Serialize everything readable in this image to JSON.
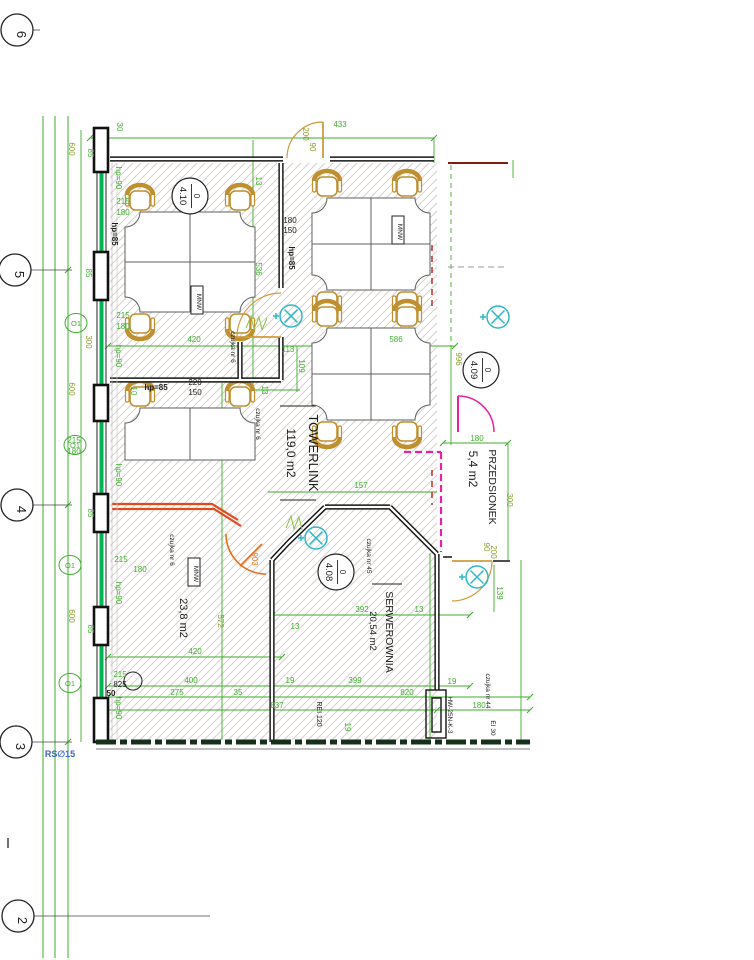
{
  "palette": {
    "dim": "#3fae2e",
    "olive": "#8a9b28",
    "black": "#1c1c1c",
    "tan": "#cf9b3d",
    "orange": "#e2711d",
    "magenta": "#e820a8",
    "teal": "#2fb6c9",
    "blue": "#3a66c4",
    "facade": "#00b551",
    "red": "#c23b22"
  },
  "drawing": {
    "grid_bubbles": [
      {
        "label": "6",
        "x": 17,
        "y": 30,
        "leader_to": 40
      },
      {
        "label": "5",
        "x": 15,
        "y": 270,
        "leader_to": 72
      },
      {
        "label": "4",
        "x": 17,
        "y": 505,
        "leader_to": 72
      },
      {
        "label": "3",
        "x": 16,
        "y": 742,
        "leader_to": 72
      },
      {
        "label": "2",
        "x": 18,
        "y": 916,
        "leader_to": 210
      }
    ],
    "room_bubbles": [
      {
        "prefix": "0",
        "number": "4.10",
        "x": 190,
        "y": 196
      },
      {
        "prefix": "0",
        "number": "4.09",
        "x": 481,
        "y": 370
      },
      {
        "prefix": "0",
        "number": "4.08",
        "x": 336,
        "y": 572
      }
    ],
    "room_labels": [
      {
        "t": "TOWERLINK",
        "x": 309,
        "y": 453,
        "r": 90,
        "c": "black",
        "s": 13
      },
      {
        "t": "119,0 m2",
        "x": 287,
        "y": 453,
        "r": 90,
        "c": "black",
        "s": 12
      },
      {
        "t": "PRZEDSIONEK",
        "x": 489,
        "y": 487,
        "r": 90,
        "c": "black",
        "s": 10.5
      },
      {
        "t": "5,4 m2",
        "x": 469,
        "y": 469,
        "r": 90,
        "c": "black",
        "s": 12
      },
      {
        "t": "SERWEROWNIA",
        "x": 386,
        "y": 632,
        "r": 90,
        "c": "black",
        "s": 10.5
      },
      {
        "t": "20,54 m2",
        "x": 370,
        "y": 631,
        "r": 90,
        "c": "black",
        "s": 9.5
      },
      {
        "t": "23,8 m2",
        "x": 180,
        "y": 618,
        "r": 90,
        "c": "black",
        "s": 11
      }
    ],
    "annotations": [
      {
        "t": "433",
        "x": 340,
        "y": 127
      },
      {
        "t": "30",
        "x": 117,
        "y": 127,
        "r": 90
      },
      {
        "t": "200",
        "x": 303,
        "y": 134,
        "r": 90,
        "c": "olive"
      },
      {
        "t": "90",
        "x": 310,
        "y": 147,
        "r": 90,
        "c": "olive"
      },
      {
        "t": "13",
        "x": 256,
        "y": 181,
        "r": 90
      },
      {
        "t": "600",
        "x": 69,
        "y": 149,
        "r": 90,
        "c": "olive"
      },
      {
        "t": "85",
        "x": 88,
        "y": 153,
        "r": 90
      },
      {
        "t": "hp=90",
        "x": 116,
        "y": 178,
        "r": 90
      },
      {
        "t": "215",
        "x": 123,
        "y": 204
      },
      {
        "t": "180",
        "x": 123,
        "y": 215
      },
      {
        "t": "hp=85",
        "x": 112,
        "y": 234,
        "r": 90,
        "c": "black",
        "w": "bold"
      },
      {
        "t": "85",
        "x": 86,
        "y": 273,
        "r": 90
      },
      {
        "t": "215",
        "x": 123,
        "y": 318
      },
      {
        "t": "180",
        "x": 123,
        "y": 329
      },
      {
        "t": "300",
        "x": 86,
        "y": 342,
        "r": 90,
        "c": "olive"
      },
      {
        "t": "hp=90",
        "x": 116,
        "y": 356,
        "r": 90
      },
      {
        "t": "600",
        "x": 69,
        "y": 389,
        "r": 90,
        "c": "olive"
      },
      {
        "t": "hp=85",
        "x": 156,
        "y": 390,
        "c": "black",
        "w": "bold"
      },
      {
        "t": "220",
        "x": 195,
        "y": 385,
        "c": "black"
      },
      {
        "t": "150",
        "x": 195,
        "y": 395,
        "c": "black"
      },
      {
        "t": "10",
        "x": 131,
        "y": 391,
        "r": 90
      },
      {
        "t": "215",
        "x": 74,
        "y": 443
      },
      {
        "t": "180",
        "x": 74,
        "y": 454
      },
      {
        "t": "hp=90",
        "x": 116,
        "y": 475,
        "r": 90
      },
      {
        "t": "85",
        "x": 88,
        "y": 513,
        "r": 90
      },
      {
        "t": "215",
        "x": 121,
        "y": 562
      },
      {
        "t": "180",
        "x": 140,
        "y": 572
      },
      {
        "t": "hp=90",
        "x": 116,
        "y": 593,
        "r": 90
      },
      {
        "t": "600",
        "x": 69,
        "y": 616,
        "r": 90,
        "c": "olive"
      },
      {
        "t": "85",
        "x": 88,
        "y": 629,
        "r": 90
      },
      {
        "t": "215",
        "x": 120,
        "y": 677
      },
      {
        "t": "825",
        "x": 120,
        "y": 687,
        "c": "black"
      },
      {
        "t": "50",
        "x": 111,
        "y": 696,
        "c": "black",
        "w": "bold"
      },
      {
        "t": "hp=90",
        "x": 116,
        "y": 708,
        "r": 90
      },
      {
        "t": "RS∅15",
        "x": 60,
        "y": 757,
        "c": "blue",
        "s": 9,
        "w": "bold"
      },
      {
        "t": "180",
        "x": 290,
        "y": 223,
        "c": "black"
      },
      {
        "t": "150",
        "x": 290,
        "y": 233,
        "c": "black"
      },
      {
        "t": "hp=85",
        "x": 289,
        "y": 258,
        "r": 90,
        "c": "black",
        "w": "bold"
      },
      {
        "t": "536",
        "x": 256,
        "y": 269,
        "r": 90
      },
      {
        "t": "420",
        "x": 194,
        "y": 342
      },
      {
        "t": "113",
        "x": 288,
        "y": 352
      },
      {
        "t": "109",
        "x": 299,
        "y": 366,
        "r": 90
      },
      {
        "t": "586",
        "x": 396,
        "y": 342
      },
      {
        "t": "13",
        "x": 262,
        "y": 390,
        "r": 90
      },
      {
        "t": "czujka nr 6",
        "x": 231,
        "y": 347,
        "r": 90,
        "c": "black",
        "s": 6.5
      },
      {
        "t": "czujka nr 6",
        "x": 256,
        "y": 424,
        "r": 90,
        "c": "black",
        "s": 6.5
      },
      {
        "t": "czujka nr 6",
        "x": 170,
        "y": 550,
        "r": 90,
        "c": "black",
        "s": 6.5
      },
      {
        "t": "157",
        "x": 361,
        "y": 488
      },
      {
        "t": "903",
        "x": 252,
        "y": 559,
        "r": 90,
        "c": "orange"
      },
      {
        "t": "czujka nr 45",
        "x": 367,
        "y": 556,
        "r": 90,
        "c": "black",
        "s": 6.5
      },
      {
        "t": "392",
        "x": 362,
        "y": 612
      },
      {
        "t": "13",
        "x": 419,
        "y": 612
      },
      {
        "t": "13",
        "x": 295,
        "y": 629
      },
      {
        "t": "572",
        "x": 218,
        "y": 621,
        "r": 90,
        "c": "olive"
      },
      {
        "t": "420",
        "x": 195,
        "y": 654
      },
      {
        "t": "400",
        "x": 191,
        "y": 683
      },
      {
        "t": "399",
        "x": 355,
        "y": 683
      },
      {
        "t": "19",
        "x": 290,
        "y": 683
      },
      {
        "t": "19",
        "x": 452,
        "y": 684
      },
      {
        "t": "820",
        "x": 407,
        "y": 695
      },
      {
        "t": "275",
        "x": 177,
        "y": 695
      },
      {
        "t": "35",
        "x": 238,
        "y": 695
      },
      {
        "t": "837",
        "x": 277,
        "y": 708
      },
      {
        "t": "19",
        "x": 345,
        "y": 727,
        "r": 90
      },
      {
        "t": "REI 120",
        "x": 317,
        "y": 714,
        "r": 90,
        "c": "black",
        "s": 7
      },
      {
        "t": "HW-25N-K-3",
        "x": 448,
        "y": 715,
        "r": 90,
        "c": "black",
        "s": 6.5
      },
      {
        "t": "czujka nr 44",
        "x": 486,
        "y": 691,
        "r": 90,
        "c": "black",
        "s": 6.5
      },
      {
        "t": "180",
        "x": 479,
        "y": 708
      },
      {
        "t": "EI 30",
        "x": 491,
        "y": 728,
        "r": 90,
        "c": "black",
        "s": 6.5
      },
      {
        "t": "996",
        "x": 456,
        "y": 359,
        "r": 90,
        "c": "olive"
      },
      {
        "t": "180",
        "x": 477,
        "y": 441
      },
      {
        "t": "300",
        "x": 507,
        "y": 500,
        "r": 90,
        "c": "olive"
      },
      {
        "t": "90",
        "x": 484,
        "y": 547,
        "r": 90,
        "c": "olive"
      },
      {
        "t": "200",
        "x": 491,
        "y": 552,
        "r": 90,
        "c": "olive"
      },
      {
        "t": "139",
        "x": 497,
        "y": 593,
        "r": 90
      }
    ],
    "o1_label": "O1",
    "o1_markers": [
      {
        "x": 76,
        "y": 323
      },
      {
        "x": 75,
        "y": 445
      },
      {
        "x": 70,
        "y": 565
      },
      {
        "x": 70,
        "y": 683
      }
    ],
    "mnw_label": "MNW",
    "mnw_boxes": [
      {
        "x": 197,
        "y": 300
      },
      {
        "x": 398,
        "y": 230
      },
      {
        "x": 194,
        "y": 572
      }
    ],
    "detectors": [
      {
        "x": 291,
        "y": 316
      },
      {
        "x": 316,
        "y": 538
      },
      {
        "x": 477,
        "y": 577
      },
      {
        "x": 498,
        "y": 317
      }
    ]
  }
}
